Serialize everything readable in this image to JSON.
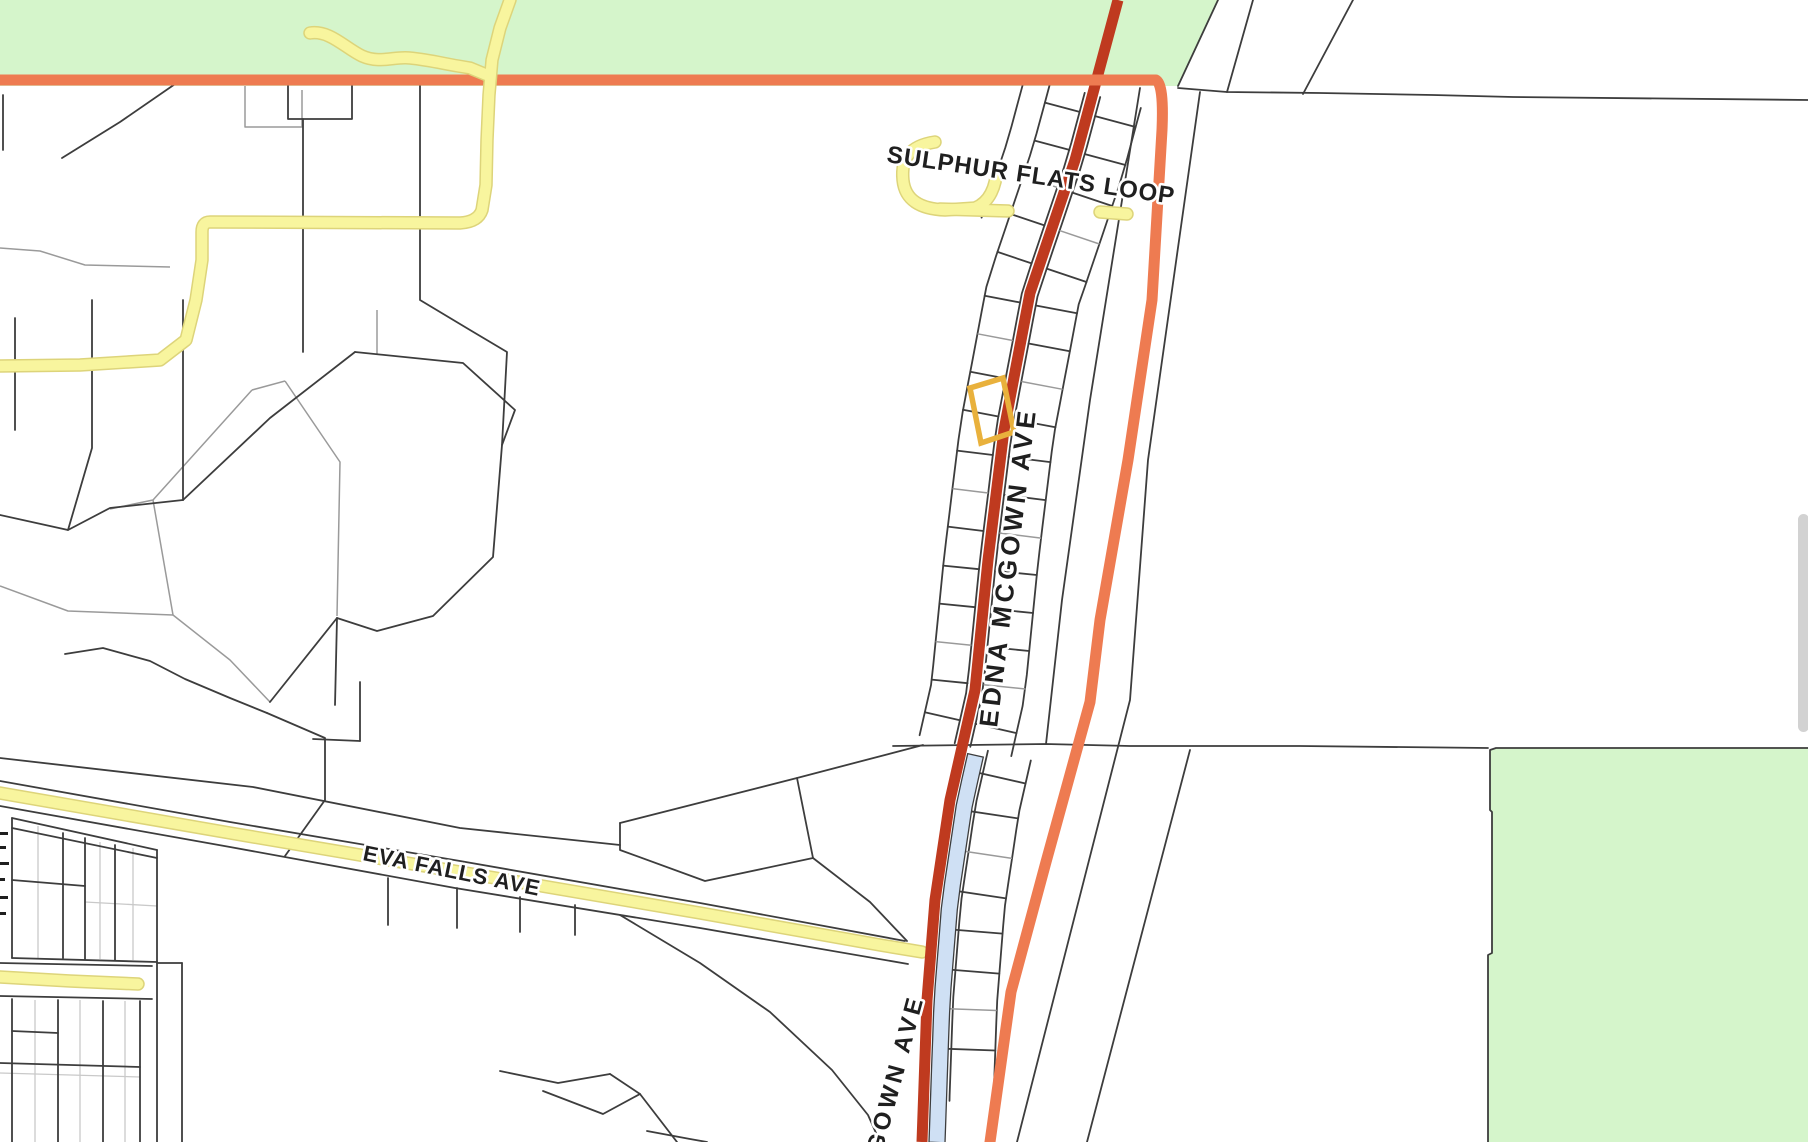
{
  "map": {
    "type": "parcel-map",
    "road_labels": [
      {
        "id": "sulphur_flats_loop",
        "text": "SULPHUR FLATS LOOP"
      },
      {
        "id": "edna_mcgown_ave",
        "text": "EDNA MCGOWN AVE"
      },
      {
        "id": "edna_mcgown_ave_partial",
        "text": "GOWN AVE"
      },
      {
        "id": "eva_falls_ave",
        "text": "EVA FALLS AVE"
      }
    ],
    "colors": {
      "background": "#ffffff",
      "park_green": "#d5f5cb",
      "boundary_orange": "#ee7b51",
      "major_road_red": "#bf3a1f",
      "road_yellow": "#f8f59e",
      "road_yellow_edge": "#ddd47a",
      "water_blue": "#cfe0f4",
      "parcel_dark": "#3d3d3d",
      "parcel_gray": "#9a9a9a",
      "parcel_light": "#c9c9c9",
      "selection_gold": "#e9b13c",
      "label_text": "#1f1f1f",
      "label_halo": "#ffffff",
      "scrollbar_thumb": "#d2d2d2"
    },
    "selected_parcel": {
      "outline_color": "#e9b13c"
    },
    "scrollbar": {
      "thumb_color": "#d2d2d2"
    }
  }
}
